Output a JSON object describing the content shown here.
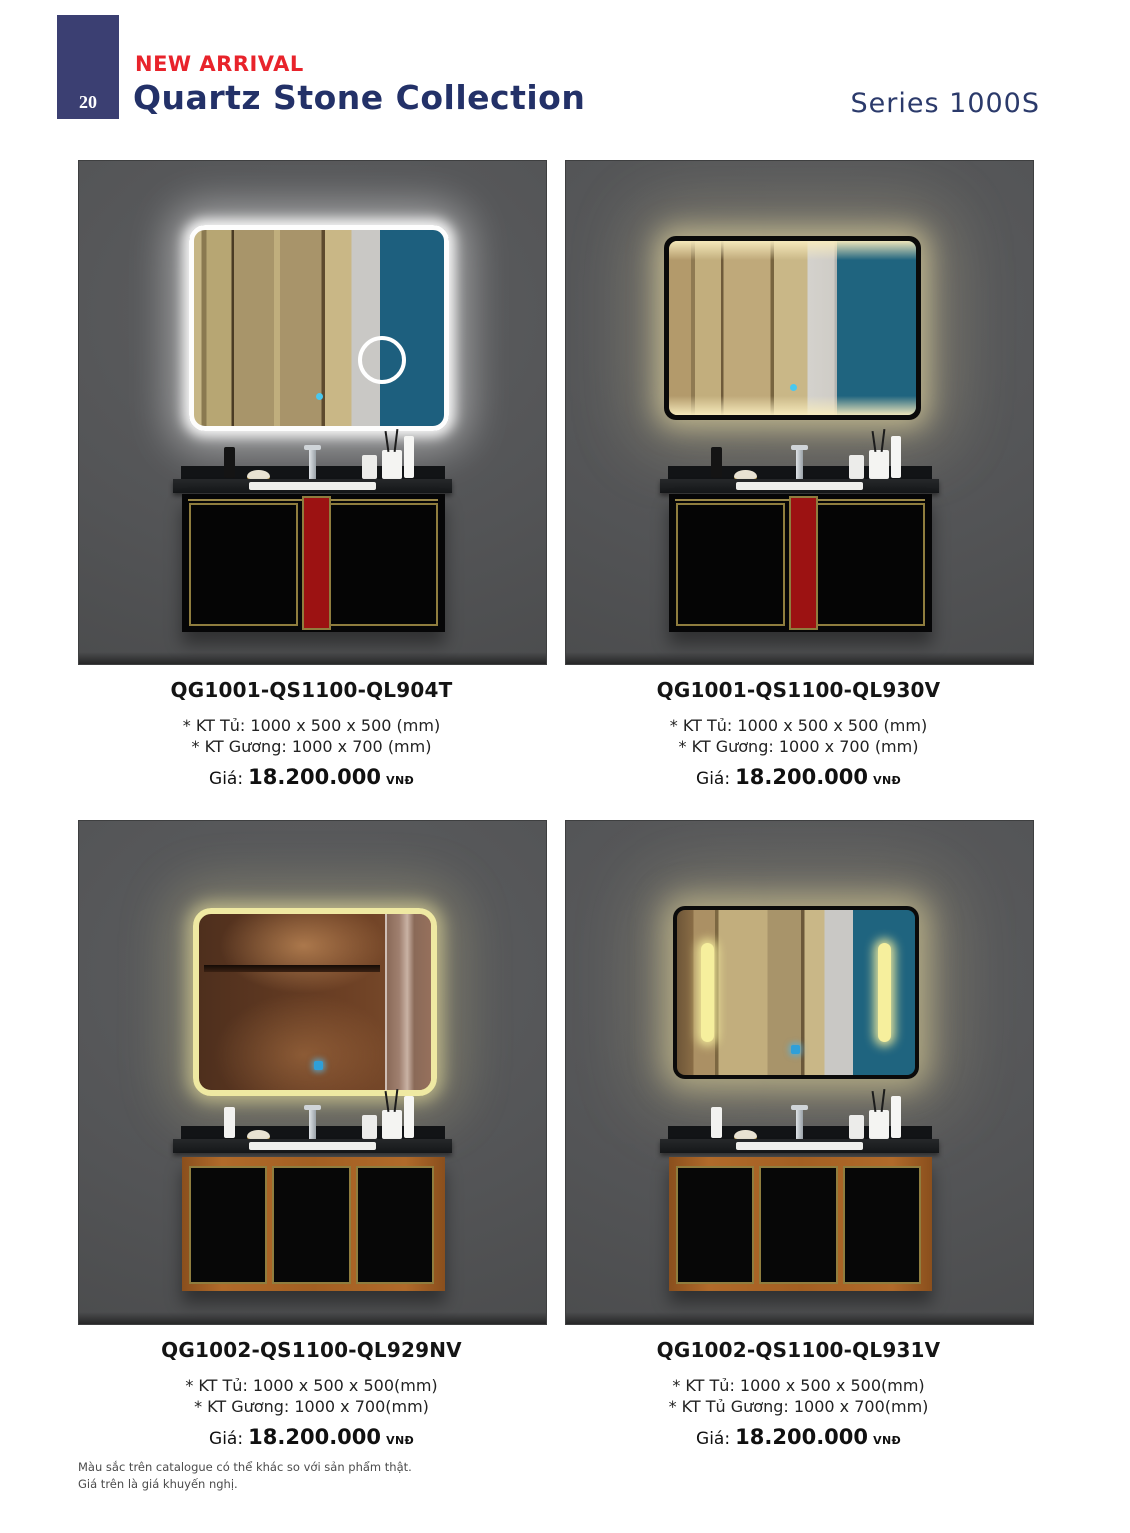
{
  "header": {
    "page_number": "20",
    "new_arrival_label": "NEW ARRIVAL",
    "title": "Quartz Stone Collection",
    "series_label": "Series 1000S"
  },
  "products": [
    {
      "code": "QG1001-QS1100-QL904T",
      "spec_cabinet": "* KT Tủ: 1000 x 500 x 500 (mm)",
      "spec_mirror": "* KT Gương: 1000 x 700 (mm)",
      "price_label": "Giá:",
      "price_value": "18.200.000",
      "currency": "VNĐ"
    },
    {
      "code": "QG1001-QS1100-QL930V",
      "spec_cabinet": "* KT Tủ: 1000 x 500 x 500 (mm)",
      "spec_mirror": "* KT Gương: 1000 x 700 (mm)",
      "price_label": "Giá:",
      "price_value": "18.200.000",
      "currency": "VNĐ"
    },
    {
      "code": "QG1002-QS1100-QL929NV",
      "spec_cabinet": "* KT Tủ: 1000 x 500 x 500(mm)",
      "spec_mirror": "* KT Gương: 1000 x 700(mm)",
      "price_label": "Giá:",
      "price_value": "18.200.000",
      "currency": "VNĐ"
    },
    {
      "code": "QG1002-QS1100-QL931V",
      "spec_cabinet": "* KT Tủ: 1000 x 500 x 500(mm)",
      "spec_mirror": "* KT Tủ Gương: 1000 x 700(mm)",
      "price_label": "Giá:",
      "price_value": "18.200.000",
      "currency": "VNĐ"
    }
  ],
  "footer": {
    "line1": "Màu sắc trên catalogue có thể khác so với sản phẩm thật.",
    "line2": "Giá trên là giá khuyến nghị."
  },
  "colors": {
    "accent_red": "#e8232b",
    "navy_text": "#233168",
    "badge_navy": "#3b3f72",
    "wall_gray": "#545557",
    "reflection_teal": "#1d5f7e",
    "cabinet_red": "#9c1212",
    "gold_trim": "#8f7d3e",
    "wood": "#a35f22",
    "led_warm": "#f6ef9d"
  }
}
